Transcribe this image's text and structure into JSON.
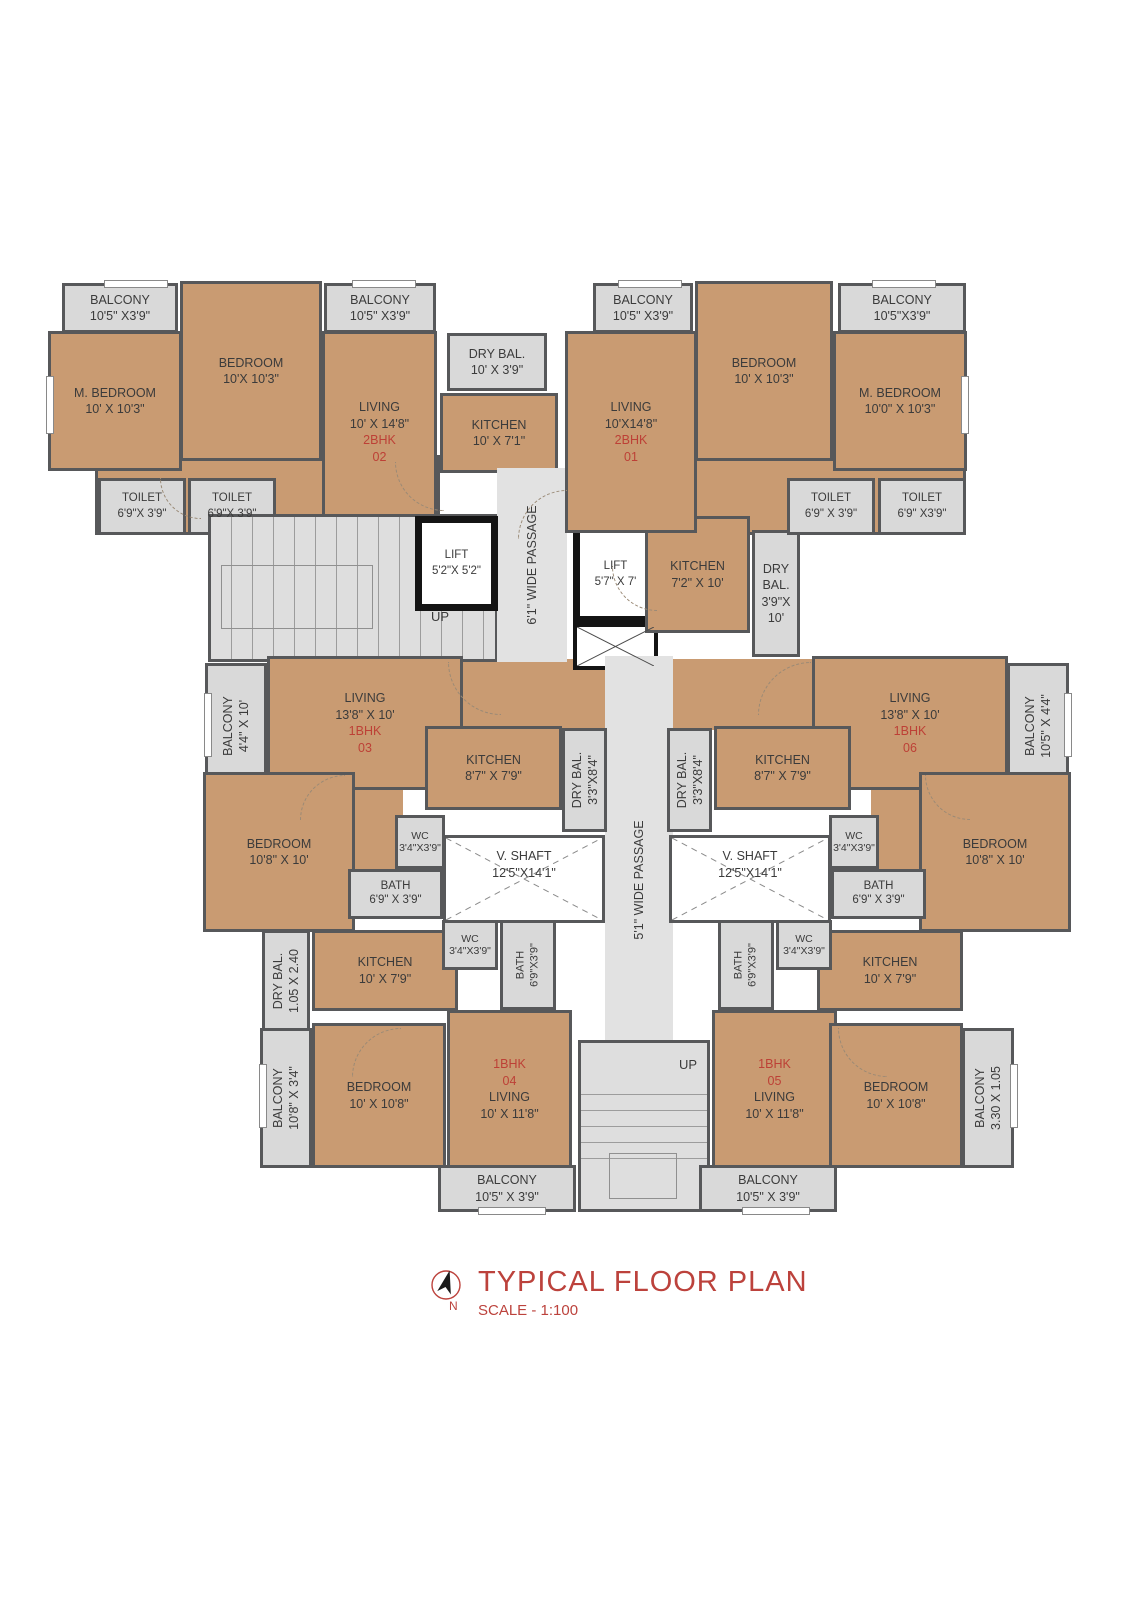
{
  "meta": {
    "title": "TYPICAL FLOOR PLAN",
    "scale": "SCALE - 1:100",
    "north_label": "N"
  },
  "colors": {
    "room_fill": "#c99b72",
    "service_fill": "#d9d9d9",
    "passage_fill": "#e2e2e2",
    "wall": "#57585a",
    "lift_wall": "#141414",
    "unit_red": "#bd4036",
    "title_red": "#bc423c",
    "text_dark": "#3b3b3b"
  },
  "labels": {
    "up": "UP"
  },
  "units": {
    "u01": {
      "type": "2BHK",
      "no": "01"
    },
    "u02": {
      "type": "2BHK",
      "no": "02"
    },
    "u03": {
      "type": "1BHK",
      "no": "03"
    },
    "u04": {
      "type": "1BHK",
      "no": "04"
    },
    "u05": {
      "type": "1BHK",
      "no": "05"
    },
    "u06": {
      "type": "1BHK",
      "no": "06"
    }
  },
  "rooms": {
    "balcony_tl1": {
      "name": "BALCONY",
      "dims": "10'5\" X3'9\""
    },
    "bedroom_tl": {
      "name": "BEDROOM",
      "dims": "10'X 10'3\""
    },
    "balcony_tl2": {
      "name": "BALCONY",
      "dims": "10'5\" X3'9\""
    },
    "mbedroom_tl": {
      "name": "M. BEDROOM",
      "dims": "10' X 10'3\""
    },
    "living_tl": {
      "name": "LIVING",
      "dims": "10' X 14'8\""
    },
    "toilet_tl1": {
      "name": "TOILET",
      "dims": "6'9\"X 3'9\""
    },
    "toilet_tl2": {
      "name": "TOILET",
      "dims": "6'9\"X 3'9\""
    },
    "drybal_tc": {
      "name": "DRY BAL.",
      "dims": "10' X 3'9\""
    },
    "kitchen_tc": {
      "name": "KITCHEN",
      "dims": "10' X 7'1\""
    },
    "lift1": {
      "name": "LIFT",
      "dims": "5'2\"X 5'2\""
    },
    "lift2": {
      "name": "LIFT",
      "dims": "5'7\" X 7'"
    },
    "passage_top": {
      "name": "6'1\" WIDE PASSAGE"
    },
    "balcony_tr1": {
      "name": "BALCONY",
      "dims": "10'5\" X3'9\""
    },
    "bedroom_tr": {
      "name": "BEDROOM",
      "dims": "10' X 10'3\""
    },
    "balcony_tr2": {
      "name": "BALCONY",
      "dims": "10'5\"X3'9\""
    },
    "living_tr": {
      "name": "LIVING",
      "dims": "10'X14'8\""
    },
    "mbedroom_tr": {
      "name": "M. BEDROOM",
      "dims": "10'0\" X 10'3\""
    },
    "kitchen_tr": {
      "name": "KITCHEN",
      "dims": "7'2\" X 10'"
    },
    "drybal_tr": {
      "name": "DRY BAL.",
      "dims": "3'9\"X 10'"
    },
    "toilet_tr1": {
      "name": "TOILET",
      "dims": "6'9\" X 3'9\""
    },
    "toilet_tr2": {
      "name": "TOILET",
      "dims": "6'9\" X3'9\""
    },
    "balcony_ml": {
      "name": "BALCONY",
      "dims": "4'4\" X 10'"
    },
    "living_ml": {
      "name": "LIVING",
      "dims": "13'8\" X 10'"
    },
    "kitchen_ml": {
      "name": "KITCHEN",
      "dims": "8'7\" X 7'9\""
    },
    "drybal_ml": {
      "name": "DRY BAL.",
      "dims": "3'3\"X8'4\""
    },
    "wc_ml": {
      "name": "WC",
      "dims": "3'4\"X3'9\""
    },
    "bath_ml": {
      "name": "BATH",
      "dims": "6'9\" X 3'9\""
    },
    "bedroom_ml": {
      "name": "BEDROOM",
      "dims": "10'8\" X 10'"
    },
    "vshaft_l": {
      "name": "V. SHAFT",
      "dims": "12'5\"X14'1\""
    },
    "passage_mid": {
      "name": "5'1\" WIDE PASSAGE"
    },
    "living_mr": {
      "name": "LIVING",
      "dims": "13'8\" X 10'"
    },
    "balcony_mr": {
      "name": "BALCONY",
      "dims": "10'5\" X 4'4\""
    },
    "kitchen_mr": {
      "name": "KITCHEN",
      "dims": "8'7\" X 7'9\""
    },
    "drybal_mr": {
      "name": "DRY BAL.",
      "dims": "3'3\"X8'4\""
    },
    "wc_mr": {
      "name": "WC",
      "dims": "3'4\"X3'9\""
    },
    "bath_mr": {
      "name": "BATH",
      "dims": "6'9\" X 3'9\""
    },
    "bedroom_mr": {
      "name": "BEDROOM",
      "dims": "10'8\" X 10'"
    },
    "vshaft_r": {
      "name": "V. SHAFT",
      "dims": "12'5\"X14'1\""
    },
    "drybal_bl": {
      "name": "DRY BAL.",
      "dims": "1.05 X 2.40"
    },
    "kitchen_bl": {
      "name": "KITCHEN",
      "dims": "10' X 7'9\""
    },
    "wc_bl": {
      "name": "WC",
      "dims": "3'4\"X3'9\""
    },
    "bath_bl": {
      "name": "BATH",
      "dims": "6'9\"X3'9\""
    },
    "balcony_bls": {
      "name": "BALCONY",
      "dims": "10'8\" X 3'4\""
    },
    "bedroom_bl": {
      "name": "BEDROOM",
      "dims": "10' X 10'8\""
    },
    "living_bl": {
      "name": "LIVING",
      "dims": "10' X 11'8\""
    },
    "balcony_blb": {
      "name": "BALCONY",
      "dims": "10'5\" X 3'9\""
    },
    "bath_br": {
      "name": "BATH",
      "dims": "6'9\"X3'9\""
    },
    "wc_br": {
      "name": "WC",
      "dims": "3'4\"X3'9\""
    },
    "kitchen_br": {
      "name": "KITCHEN",
      "dims": "10' X 7'9\""
    },
    "living_br": {
      "name": "LIVING",
      "dims": "10' X 11'8\""
    },
    "bedroom_br": {
      "name": "BEDROOM",
      "dims": "10' X 10'8\""
    },
    "balcony_brs": {
      "name": "BALCONY",
      "dims": "3.30 X 1.05"
    },
    "balcony_brb": {
      "name": "BALCONY",
      "dims": "10'5\" X 3'9\""
    }
  }
}
